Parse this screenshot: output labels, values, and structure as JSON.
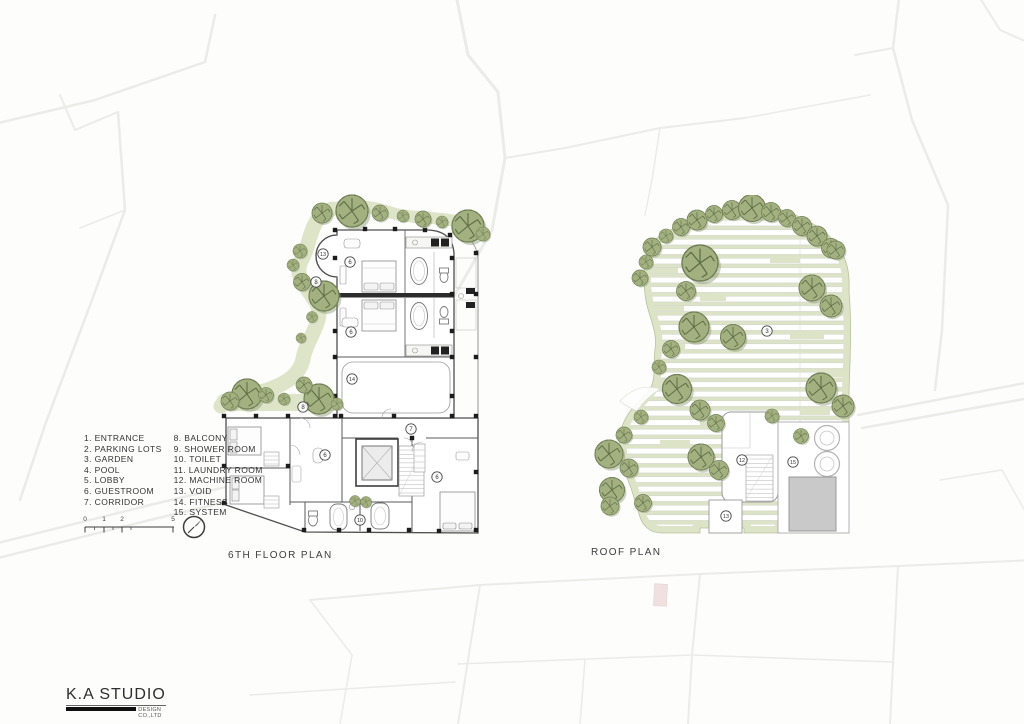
{
  "plans": {
    "floor6": {
      "title": "6TH FLOOR PLAN",
      "markers": [
        {
          "n": "13",
          "x": 323,
          "y": 254
        },
        {
          "n": "6",
          "x": 350,
          "y": 262
        },
        {
          "n": "8",
          "x": 316,
          "y": 282
        },
        {
          "n": "6",
          "x": 351,
          "y": 332
        },
        {
          "n": "14",
          "x": 352,
          "y": 379
        },
        {
          "n": "8",
          "x": 303,
          "y": 407
        },
        {
          "n": "7",
          "x": 411,
          "y": 429
        },
        {
          "n": "6",
          "x": 325,
          "y": 455
        },
        {
          "n": "6",
          "x": 437,
          "y": 477
        },
        {
          "n": "10",
          "x": 360,
          "y": 520
        }
      ]
    },
    "roof": {
      "title": "ROOF PLAN",
      "markers": [
        {
          "n": "3",
          "x": 767,
          "y": 331
        },
        {
          "n": "12",
          "x": 742,
          "y": 460
        },
        {
          "n": "15",
          "x": 793,
          "y": 462
        },
        {
          "n": "13",
          "x": 726,
          "y": 516
        }
      ]
    }
  },
  "legend": {
    "col1": [
      "1. ENTRANCE",
      "2. PARKING LOTS",
      "3. GARDEN",
      "4. POOL",
      "5. LOBBY",
      "6. GUESTROOM",
      "7. CORRIDOR"
    ],
    "col2": [
      "8. BALCONY",
      "9. SHOWER ROOM",
      "10. TOILET",
      "11. LAUNDRY ROOM",
      "12. MACHINE ROOM",
      "13. VOID",
      "14. FITNESS",
      "15. SYSTEM"
    ]
  },
  "scalebar": {
    "labels": [
      {
        "t": "0",
        "x": 2
      },
      {
        "t": "1",
        "x": 21
      },
      {
        "t": "2",
        "x": 39
      },
      {
        "t": "5",
        "x": 90
      }
    ]
  },
  "logo": {
    "name": "K.A STUDIO",
    "subtitle": "DESIGN CO.,LTD"
  },
  "colors": {
    "tree_green": "#a3b180",
    "tree_line": "#5f6d47",
    "garden_green": "#dde4c8",
    "deck_green": "#dce3c6",
    "wall_gray": "#4f4f4f",
    "site_line": "#ebebe8"
  }
}
